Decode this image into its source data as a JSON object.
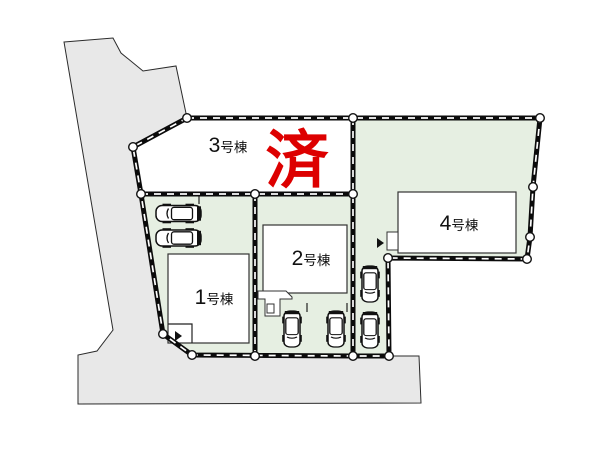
{
  "plots": [
    {
      "name": "1号棟",
      "num": "1",
      "suffix": "号棟"
    },
    {
      "name": "2号棟",
      "num": "2",
      "suffix": "号棟"
    },
    {
      "name": "3号棟",
      "num": "3",
      "suffix": "号棟",
      "status": "済"
    },
    {
      "name": "4号棟",
      "num": "4",
      "suffix": "号棟"
    }
  ],
  "sold_stamp": {
    "text": "済"
  },
  "colors": {
    "plot_green": "#e6efe2",
    "road_gray": "#e8e8e8",
    "sold_red": "#dd0000",
    "line_black": "#111111"
  },
  "icons": {
    "car": "car-top-view-icon",
    "entrance": "entrance-arrow-icon",
    "vertex": "survey-point-dot"
  }
}
